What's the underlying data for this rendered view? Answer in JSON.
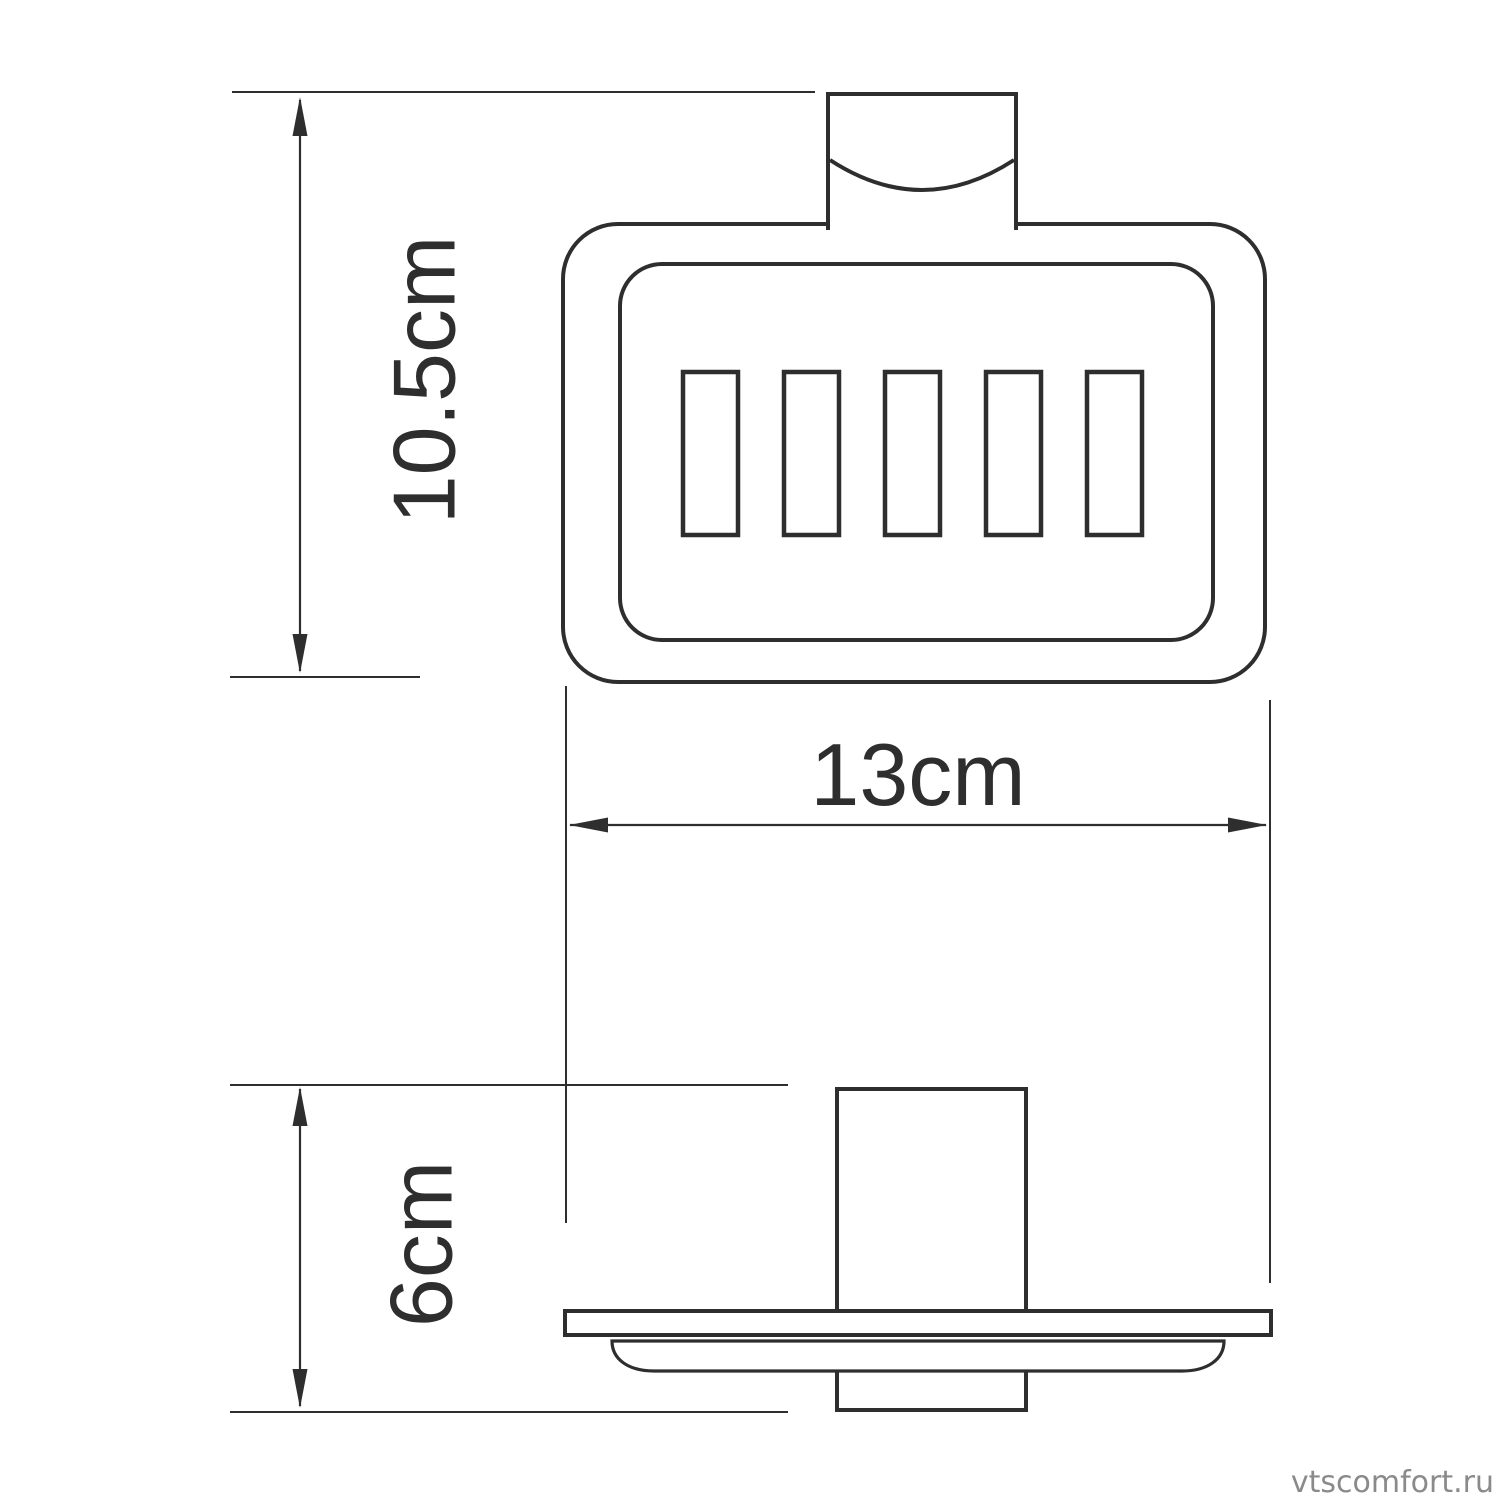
{
  "theme": {
    "background": "#ffffff",
    "line_color": "#2e2e2e"
  },
  "drawing": {
    "dimension_labels": {
      "height": {
        "label": "10.5cm",
        "value_cm": 10.5,
        "orientation": "vertical"
      },
      "width": {
        "label": "13cm",
        "value_cm": 13,
        "orientation": "horizontal"
      },
      "depth": {
        "label": "6cm",
        "value_cm": 6,
        "orientation": "vertical"
      }
    },
    "slot_count": 5
  },
  "watermark": {
    "text": "vtscomfort.ru",
    "color": "#8a8a8a"
  }
}
